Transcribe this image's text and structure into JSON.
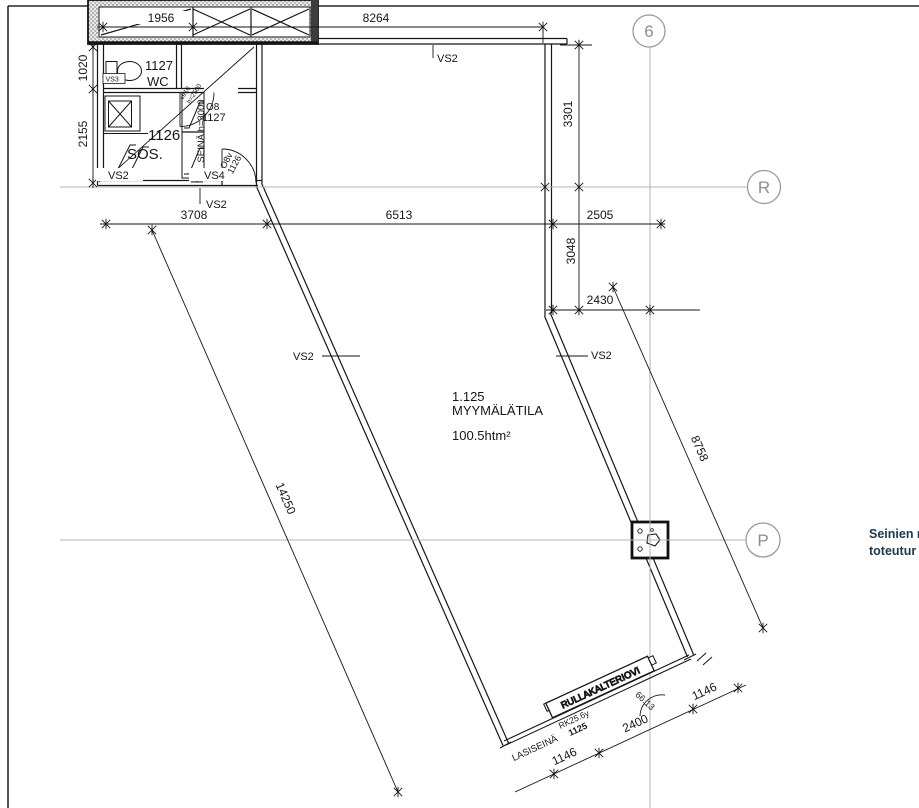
{
  "note": {
    "line1": "Seinien r",
    "line2": "toteutur"
  },
  "grid_bubbles": {
    "b6": "6",
    "bR": "R",
    "bP": "P"
  },
  "room_shop": {
    "number": "1.125",
    "name": "MYYMÄLÄTILA",
    "area": "100.5htm²"
  },
  "room_sos": {
    "number": "1126",
    "name": "SOS."
  },
  "room_wc": {
    "number": "1127",
    "name": "WC"
  },
  "wall_tags": {
    "vs2": "VS2",
    "vs3": "VS3",
    "vs4": "VS4",
    "seina_h": "SEINÄ h=3000",
    "lasiseina": "LASISEINÄ",
    "roller_door": "RULLAKALTERIOVI"
  },
  "door_tags": {
    "o8": "O8",
    "o8_room": "1127",
    "o8v": "O8v",
    "o8v_room": "1126",
    "ve": "ve10",
    "ve_h": "h=2500",
    "rk": "RK25.6y",
    "rk_room": "1125"
  },
  "dimensions": {
    "top_left": "1956",
    "top_right": "8264",
    "left_upper": "1020",
    "left_lower": "2155",
    "right_upper": "3301",
    "right_mid": "3048",
    "right_small": "2430",
    "mid_left": "3708",
    "mid_center": "6513",
    "mid_right": "2505",
    "diag_left": "14250",
    "diag_right": "8758",
    "front_door": "2400",
    "front_left": "1146",
    "front_right": "1146",
    "angle": "66.13"
  }
}
